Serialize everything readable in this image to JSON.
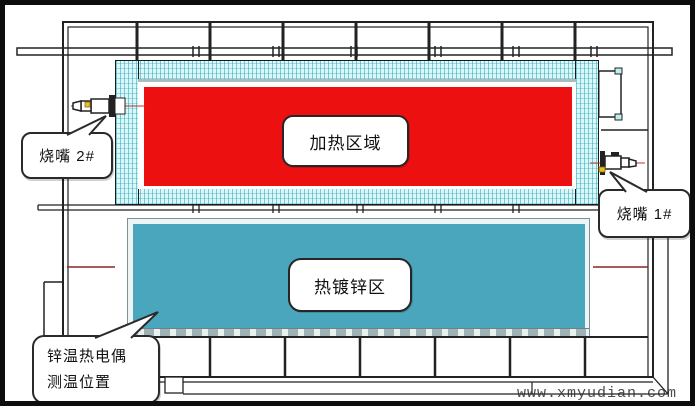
{
  "diagram": {
    "type": "furnace-galvanizing-line-section",
    "zones": {
      "heating": {
        "label": "加热区域",
        "fill": "#ec1010"
      },
      "galvanizing": {
        "label": "热镀锌区",
        "fill": "#4aa6bd"
      }
    },
    "callouts": {
      "burner2": {
        "label": "烧嘴 2#"
      },
      "burner1": {
        "label": "烧嘴 1#"
      },
      "thermocouple": {
        "line1": "锌温热电偶",
        "line2": "测温位置"
      }
    },
    "colors": {
      "insulation_hatch": "#ddf6f8",
      "structure_line": "#222222",
      "pass_line_red": "#8b2525",
      "burner_accent_yellow": "#e8c020"
    }
  },
  "watermark": {
    "text": "www.xmyudian.com"
  }
}
